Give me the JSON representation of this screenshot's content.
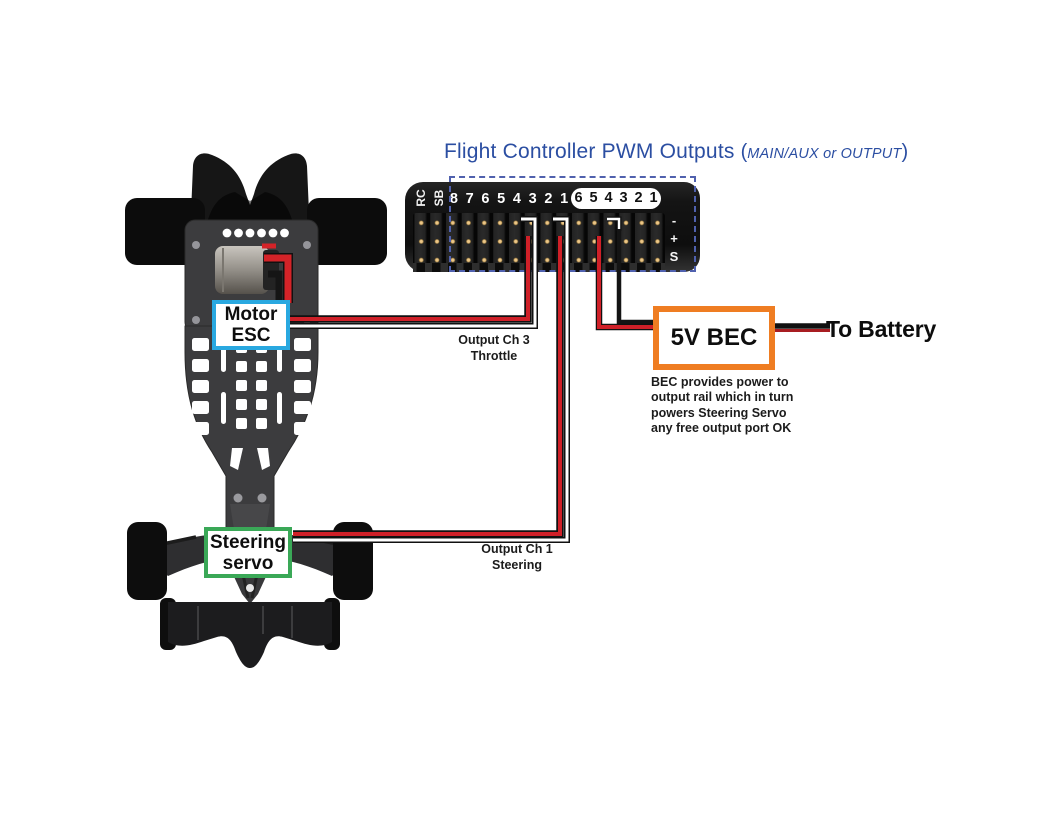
{
  "title": {
    "text": "Flight Controller PWM Outputs",
    "paren_open": "(",
    "note": "MAIN/AUX or OUTPUT",
    "paren_close": ")"
  },
  "flight_controller": {
    "side_labels": [
      "RC",
      "SB"
    ],
    "main_pins": [
      "8",
      "7",
      "6",
      "5",
      "4",
      "3",
      "2",
      "1"
    ],
    "aux_pins": [
      "6",
      "5",
      "4",
      "3",
      "2",
      "1"
    ],
    "rail_labels": [
      "-",
      "+",
      "S"
    ]
  },
  "boxes": {
    "motor_esc": {
      "line1": "Motor",
      "line2": "ESC"
    },
    "steering_servo": {
      "line1": "Steering",
      "line2": "servo"
    },
    "bec": {
      "label": "5V BEC"
    }
  },
  "captions": {
    "ch3_line1": "Output Ch 3",
    "ch3_line2": "Throttle",
    "ch1_line1": "Output Ch 1",
    "ch1_line2": "Steering",
    "to_battery": "To Battery",
    "bec_note_line1": "BEC provides power to",
    "bec_note_line2": "output rail which in turn",
    "bec_note_line3": "powers Steering Servo",
    "bec_note_line4": "any free output port OK"
  },
  "colors": {
    "title_blue": "#2b4ea2",
    "esc_box_border": "#29a8e0",
    "servo_box_border": "#3aa857",
    "bec_box_border": "#ef7d22",
    "wire_red": "#cf2028",
    "wire_black": "#141414",
    "wire_white": "#ffffff",
    "dashed_border": "#5061ae"
  }
}
